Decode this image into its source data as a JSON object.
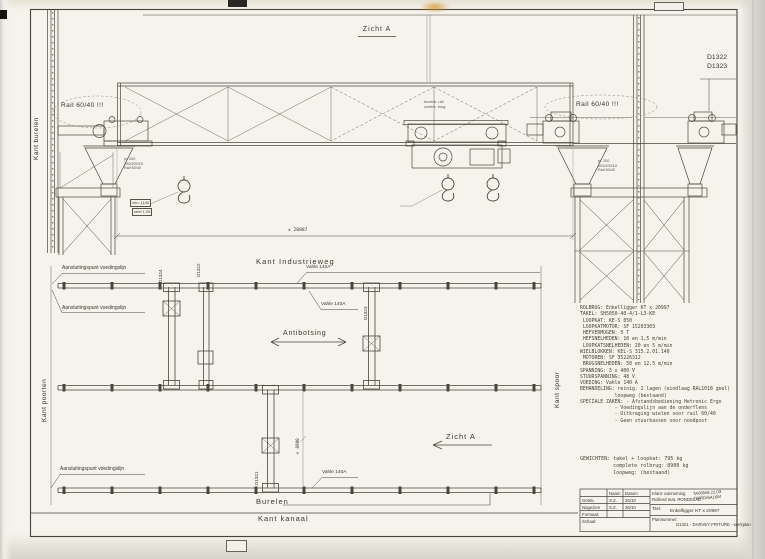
{
  "elevation": {
    "view_title": "Zicht A",
    "rail_label_left": "Rail 60/40 !!!",
    "rail_label_right": "Rail 60/40 !!!",
    "ref_d1322": "D1322",
    "ref_d1323": "D1323",
    "side_label_left": "Kant burelen",
    "overall_dim": "± 20887",
    "note_mid_1": "bovenk. rail",
    "note_mid_2": "onderk. brug",
    "funnel_note_1": "pl. 200",
    "funnel_note_2": "200/100/10",
    "funnel_note_3": "Rail 60/40",
    "hook_note_1": "min. 1190",
    "hook_note_2": "tafel 1.05"
  },
  "plan": {
    "top_edge_label": "Kant Industrieweg",
    "burelen_label": "Burelen",
    "kanaal_label": "Kant kanaal",
    "side_label_left": "Kant poorten",
    "side_label_right": "Kant spoor",
    "busbar_labels": [
      "Vahle 140A",
      "Vahle 140A",
      "Vahle 140A"
    ],
    "feed_point_labels": [
      "Aansluitingspunt voedingslijn",
      "Aansluitingspunt voedingslijn",
      "Aansluitingspunt voedingslijn"
    ],
    "anti_collision_label": "Antibotsing",
    "view_arrow_label": "Zicht A",
    "crane_id_d1324": "D1324",
    "crane_id_d1322": "D1322",
    "crane_id_d1323": "D1323",
    "crane_id_d1321": "D1321",
    "dim_label": "± 8900"
  },
  "specs": {
    "lines": [
      "ROLBRUG: Enkelligger KT x 20997",
      "TAKEL: SH5050-40-4/1-L3-KE",
      " LOOPKAT: KE-S 050",
      " LOOPKATMOTOR: SF 15203303",
      " HEFVERMOGEN: 5 T",
      " HEFSNELHEDEN: 10 en 1,5 m/min",
      " LOOPKATSNELHEDEN: 20 en 5 m/min",
      "WIELBLOKKEN: KEL-S 315.2.01.140",
      " MOTOREN: SF 35226312",
      " BRUGSNELHEDEN: 50 en 12,5 m/min",
      "SPANNING: 3 x 400 V",
      "STUURSPANNING: 48 V",
      "VOEDING: Vahle 140 A",
      "BEHANDELING: reinig. 2 lagen (eindlaag RAL1018 geel)",
      "            loopweg (bestaand)",
      "SPECIALE ZAKEN: - Afstandsbediening Hetronic Ergo",
      "            - Voedingslijn aan de onderflens",
      "            - Uitkraging wielen voor rail 60/40",
      "            - Geen stuurkassen voor noodpost"
    ]
  },
  "weights": {
    "lines": [
      "GEWICHTEN: takel + loopkat: 795 kg",
      "           complete rolbrug: 8900 kg",
      "           loopweg: (bestaand)"
    ]
  },
  "titleblock": {
    "naam_header": "Naam",
    "datum_header": "Datum",
    "row1_label": "Getek.",
    "row1_naam": "S.Z.",
    "row1_datum": "25/10",
    "row2_label": "Nagezien",
    "row2_naam": "S.Z.",
    "row2_datum": "25/10",
    "row3_label": "Formaat:",
    "row4_label": "Schaal:",
    "klant_line1": "Klant: aanneming",
    "klant_line2": "Rollend mat. RONDELAE",
    "note_line1": "TA06N/6.11.03",
    "note_line2": "TWRD/6A16M",
    "titel_label": "Titel:",
    "titel_value": "Enkelligger KT x 20997",
    "plan_label": "Plannummer:",
    "plan_value": "D1321 - DARVEY FRITURE - werkplan"
  }
}
